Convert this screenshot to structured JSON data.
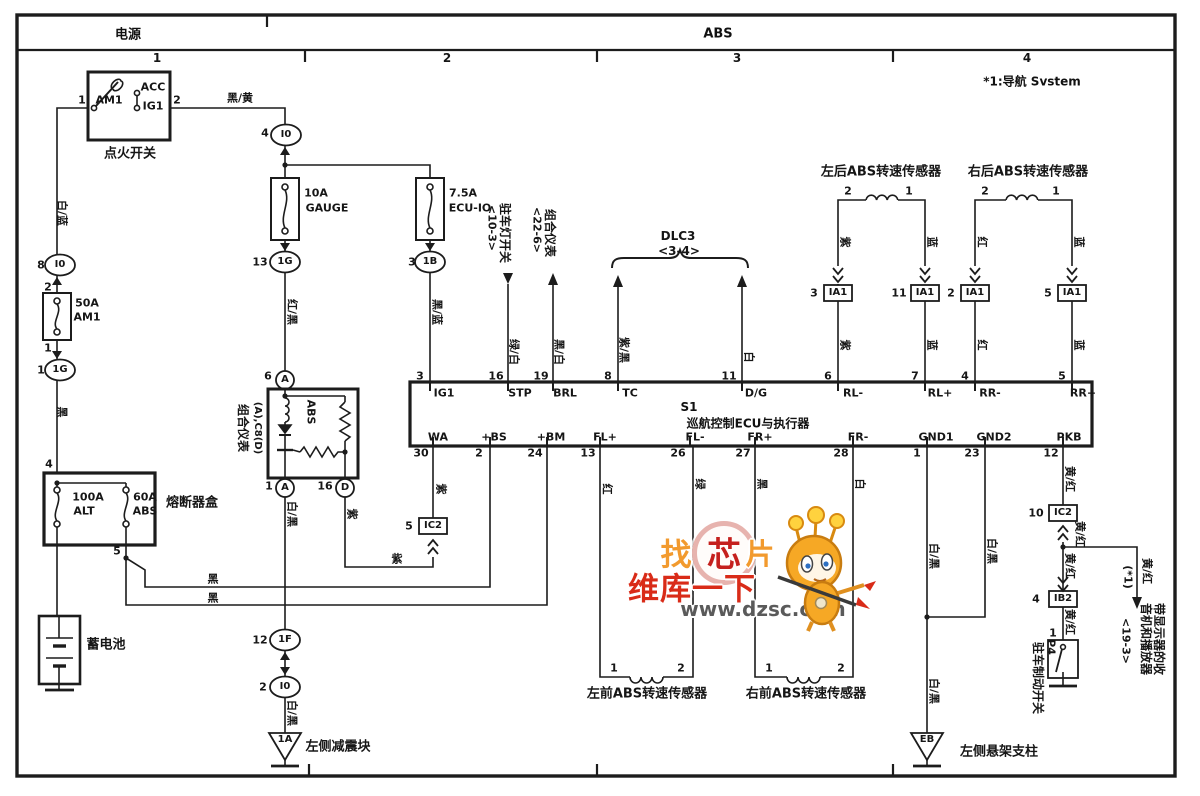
{
  "header": {
    "power_label": "电源",
    "system_label": "ABS",
    "note": "*1:导航 Svstem",
    "columns": [
      "1",
      "2",
      "3",
      "4"
    ],
    "column_xs": [
      157,
      447,
      737,
      1027
    ],
    "column_y": 58
  },
  "ecu": {
    "id": "S1",
    "name": "巡航控制ECU与执行器"
  },
  "watermark": {
    "char_left": "找",
    "char_mid": "芯",
    "char_right": "片",
    "brand": "维库一下",
    "url": "www.dzsc.com",
    "orange": "#f29a2e",
    "red": "#d92b18",
    "url_gray": "#5a5a5a"
  },
  "colors": {
    "line": "#1c1c1c",
    "paper": "#ffffff"
  },
  "labels": [
    {
      "n": "component-label",
      "t": "点火开关",
      "x": 130,
      "y": 154,
      "s": 13
    },
    {
      "n": "terminal-label",
      "t": "AM1",
      "x": 109,
      "y": 100,
      "s": 11
    },
    {
      "n": "terminal-label",
      "t": "ACC",
      "x": 153,
      "y": 87,
      "s": 11
    },
    {
      "n": "terminal-label",
      "t": "IG1",
      "x": 153,
      "y": 106,
      "s": 11
    },
    {
      "n": "pin-number",
      "t": "1",
      "x": 82,
      "y": 100,
      "s": 11
    },
    {
      "n": "pin-number",
      "t": "2",
      "x": 177,
      "y": 100,
      "s": 11
    },
    {
      "n": "wire-color-label",
      "t": "黑/黄",
      "x": 240,
      "y": 98,
      "s": 11
    },
    {
      "n": "wire-color-label",
      "t": "白/蓝",
      "x": 62,
      "y": 213,
      "r": 1,
      "s": 11
    },
    {
      "n": "pin-number",
      "t": "8",
      "x": 41,
      "y": 265,
      "s": 11
    },
    {
      "n": "connector-label",
      "t": "I0",
      "x": 60,
      "y": 265,
      "s": 10
    },
    {
      "n": "pin-number",
      "t": "2",
      "x": 48,
      "y": 287,
      "s": 11
    },
    {
      "n": "fuse-label",
      "t": "50A",
      "x": 87,
      "y": 303,
      "s": 11
    },
    {
      "n": "fuse-label",
      "t": "AM1",
      "x": 87,
      "y": 317,
      "s": 11
    },
    {
      "n": "pin-number",
      "t": "1",
      "x": 48,
      "y": 348,
      "s": 11
    },
    {
      "n": "pin-number",
      "t": "1",
      "x": 41,
      "y": 370,
      "s": 11
    },
    {
      "n": "connector-label",
      "t": "1G",
      "x": 60,
      "y": 370,
      "s": 10
    },
    {
      "n": "wire-color-label",
      "t": "黑",
      "x": 62,
      "y": 412,
      "r": 1,
      "s": 11
    },
    {
      "n": "pin-number",
      "t": "4",
      "x": 49,
      "y": 464,
      "s": 11
    },
    {
      "n": "fuse-label",
      "t": "100A",
      "x": 88,
      "y": 497,
      "s": 11
    },
    {
      "n": "fuse-label",
      "t": "ALT",
      "x": 84,
      "y": 511,
      "s": 11
    },
    {
      "n": "fuse-label",
      "t": "60A",
      "x": 145,
      "y": 497,
      "s": 11
    },
    {
      "n": "fuse-label",
      "t": "ABS",
      "x": 145,
      "y": 511,
      "s": 11
    },
    {
      "n": "component-label",
      "t": "熔断器盒",
      "x": 192,
      "y": 503,
      "s": 13
    },
    {
      "n": "pin-number",
      "t": "5",
      "x": 117,
      "y": 551,
      "s": 11
    },
    {
      "n": "component-label",
      "t": "蓄电池",
      "x": 106,
      "y": 645,
      "s": 13
    },
    {
      "n": "wire-color-label",
      "t": "黑",
      "x": 213,
      "y": 579,
      "s": 11
    },
    {
      "n": "wire-color-label",
      "t": "黑",
      "x": 213,
      "y": 598,
      "s": 11
    },
    {
      "n": "pin-number",
      "t": "4",
      "x": 265,
      "y": 133,
      "s": 11
    },
    {
      "n": "connector-label",
      "t": "I0",
      "x": 286,
      "y": 135,
      "s": 10
    },
    {
      "n": "fuse-label",
      "t": "10A",
      "x": 316,
      "y": 193,
      "s": 11
    },
    {
      "n": "fuse-label",
      "t": "GAUGE",
      "x": 327,
      "y": 208,
      "s": 11
    },
    {
      "n": "fuse-label",
      "t": "7.5A",
      "x": 463,
      "y": 193,
      "s": 11
    },
    {
      "n": "fuse-label",
      "t": "ECU-IO",
      "x": 470,
      "y": 208,
      "s": 11
    },
    {
      "n": "pin-number",
      "t": "13",
      "x": 260,
      "y": 262,
      "s": 11
    },
    {
      "n": "connector-label",
      "t": "1G",
      "x": 285,
      "y": 262,
      "s": 10
    },
    {
      "n": "wire-color-label",
      "t": "红/黑",
      "x": 292,
      "y": 312,
      "r": 1,
      "s": 11
    },
    {
      "n": "pin-number",
      "t": "3",
      "x": 412,
      "y": 262,
      "s": 11
    },
    {
      "n": "connector-label",
      "t": "1B",
      "x": 430,
      "y": 262,
      "s": 10
    },
    {
      "n": "wire-color-label",
      "t": "黑/蓝",
      "x": 437,
      "y": 312,
      "r": 1,
      "s": 11
    },
    {
      "n": "pin-number",
      "t": "6",
      "x": 268,
      "y": 376,
      "s": 11
    },
    {
      "n": "connector-label",
      "t": "A",
      "x": 285,
      "y": 380,
      "s": 10
    },
    {
      "n": "component-label",
      "t": "组合仪表",
      "x": 243,
      "y": 428,
      "r": 1,
      "s": 12
    },
    {
      "n": "component-label",
      "t": "(A),C8(D)",
      "x": 257,
      "y": 428,
      "r": 1,
      "s": 10
    },
    {
      "n": "lamp-label",
      "t": "ABS",
      "x": 311,
      "y": 412,
      "r": 1,
      "s": 11
    },
    {
      "n": "pin-number",
      "t": "1",
      "x": 269,
      "y": 486,
      "s": 11
    },
    {
      "n": "connector-label",
      "t": "A",
      "x": 285,
      "y": 488,
      "s": 10
    },
    {
      "n": "pin-number",
      "t": "16",
      "x": 325,
      "y": 486,
      "s": 11
    },
    {
      "n": "connector-label",
      "t": "D",
      "x": 345,
      "y": 488,
      "s": 10
    },
    {
      "n": "wire-color-label",
      "t": "白/黑",
      "x": 292,
      "y": 514,
      "r": 1,
      "s": 11
    },
    {
      "n": "wire-color-label",
      "t": "紫",
      "x": 352,
      "y": 514,
      "r": 1,
      "s": 11
    },
    {
      "n": "wire-color-label",
      "t": "紫",
      "x": 397,
      "y": 559,
      "s": 11
    },
    {
      "n": "pin-number",
      "t": "5",
      "x": 409,
      "y": 526,
      "s": 11
    },
    {
      "n": "connector-label",
      "t": "IC2",
      "x": 433,
      "y": 526,
      "s": 10
    },
    {
      "n": "wire-color-label",
      "t": "紫",
      "x": 441,
      "y": 489,
      "r": 1,
      "s": 11
    },
    {
      "n": "pin-number",
      "t": "12",
      "x": 260,
      "y": 640,
      "s": 11
    },
    {
      "n": "connector-label",
      "t": "1F",
      "x": 285,
      "y": 640,
      "s": 10
    },
    {
      "n": "pin-number",
      "t": "2",
      "x": 263,
      "y": 687,
      "s": 11
    },
    {
      "n": "connector-label",
      "t": "I0",
      "x": 285,
      "y": 687,
      "s": 10
    },
    {
      "n": "wire-color-label",
      "t": "白/黑",
      "x": 292,
      "y": 713,
      "r": 1,
      "s": 11
    },
    {
      "n": "ground-id",
      "t": "1A",
      "x": 285,
      "y": 740,
      "s": 10
    },
    {
      "n": "component-label",
      "t": "左侧减震块",
      "x": 338,
      "y": 747,
      "s": 13
    },
    {
      "n": "pin-number",
      "t": "3",
      "x": 420,
      "y": 376,
      "s": 11
    },
    {
      "n": "ecu-pin-label",
      "t": "IG1",
      "x": 444,
      "y": 393,
      "s": 11
    },
    {
      "n": "pin-number",
      "t": "16",
      "x": 496,
      "y": 376,
      "s": 11
    },
    {
      "n": "ecu-pin-label",
      "t": "STP",
      "x": 520,
      "y": 393,
      "s": 11
    },
    {
      "n": "pin-number",
      "t": "19",
      "x": 541,
      "y": 376,
      "s": 11
    },
    {
      "n": "ecu-pin-label",
      "t": "BRL",
      "x": 565,
      "y": 393,
      "s": 11
    },
    {
      "n": "pin-number",
      "t": "8",
      "x": 608,
      "y": 376,
      "s": 11
    },
    {
      "n": "ecu-pin-label",
      "t": "TC",
      "x": 630,
      "y": 393,
      "s": 11
    },
    {
      "n": "pin-number",
      "t": "11",
      "x": 729,
      "y": 376,
      "s": 11
    },
    {
      "n": "ecu-pin-label",
      "t": "D/G",
      "x": 756,
      "y": 393,
      "s": 11
    },
    {
      "n": "pin-number",
      "t": "6",
      "x": 828,
      "y": 376,
      "s": 11
    },
    {
      "n": "ecu-pin-label",
      "t": "RL-",
      "x": 853,
      "y": 393,
      "s": 11
    },
    {
      "n": "pin-number",
      "t": "7",
      "x": 915,
      "y": 376,
      "s": 11
    },
    {
      "n": "ecu-pin-label",
      "t": "RL+",
      "x": 940,
      "y": 393,
      "s": 11
    },
    {
      "n": "pin-number",
      "t": "4",
      "x": 965,
      "y": 376,
      "s": 11
    },
    {
      "n": "ecu-pin-label",
      "t": "RR-",
      "x": 990,
      "y": 393,
      "s": 11
    },
    {
      "n": "pin-number",
      "t": "5",
      "x": 1062,
      "y": 376,
      "s": 11
    },
    {
      "n": "ecu-pin-label",
      "t": "RR+",
      "x": 1083,
      "y": 393,
      "s": 11
    },
    {
      "n": "ecu-pin-label",
      "t": "WA",
      "x": 438,
      "y": 437,
      "s": 11
    },
    {
      "n": "pin-number",
      "t": "30",
      "x": 421,
      "y": 453,
      "s": 11
    },
    {
      "n": "ecu-pin-label",
      "t": "+BS",
      "x": 494,
      "y": 437,
      "s": 11
    },
    {
      "n": "pin-number",
      "t": "2",
      "x": 479,
      "y": 453,
      "s": 11
    },
    {
      "n": "ecu-pin-label",
      "t": "+BM",
      "x": 551,
      "y": 437,
      "s": 11
    },
    {
      "n": "pin-number",
      "t": "24",
      "x": 535,
      "y": 453,
      "s": 11
    },
    {
      "n": "ecu-pin-label",
      "t": "FL+",
      "x": 605,
      "y": 437,
      "s": 11
    },
    {
      "n": "pin-number",
      "t": "13",
      "x": 588,
      "y": 453,
      "s": 11
    },
    {
      "n": "ecu-pin-label",
      "t": "FL-",
      "x": 695,
      "y": 437,
      "s": 11
    },
    {
      "n": "pin-number",
      "t": "26",
      "x": 678,
      "y": 453,
      "s": 11
    },
    {
      "n": "ecu-pin-label",
      "t": "FR+",
      "x": 760,
      "y": 437,
      "s": 11
    },
    {
      "n": "pin-number",
      "t": "27",
      "x": 743,
      "y": 453,
      "s": 11
    },
    {
      "n": "ecu-pin-label",
      "t": "FR-",
      "x": 858,
      "y": 437,
      "s": 11
    },
    {
      "n": "pin-number",
      "t": "28",
      "x": 841,
      "y": 453,
      "s": 11
    },
    {
      "n": "ecu-pin-label",
      "t": "GND1",
      "x": 936,
      "y": 437,
      "s": 11
    },
    {
      "n": "pin-number",
      "t": "1",
      "x": 917,
      "y": 453,
      "s": 11
    },
    {
      "n": "ecu-pin-label",
      "t": "GND2",
      "x": 994,
      "y": 437,
      "s": 11
    },
    {
      "n": "pin-number",
      "t": "23",
      "x": 972,
      "y": 453,
      "s": 11
    },
    {
      "n": "ecu-pin-label",
      "t": "PKB",
      "x": 1069,
      "y": 437,
      "s": 11
    },
    {
      "n": "pin-number",
      "t": "12",
      "x": 1051,
      "y": 453,
      "s": 11
    },
    {
      "n": "dest-label",
      "t": "驻车灯开关",
      "x": 505,
      "y": 233,
      "r": 1,
      "s": 12
    },
    {
      "n": "dest-ref",
      "t": "<10-3>",
      "x": 492,
      "y": 228,
      "r": 1,
      "s": 11
    },
    {
      "n": "dest-label",
      "t": "组合仪表",
      "x": 550,
      "y": 233,
      "r": 1,
      "s": 12
    },
    {
      "n": "dest-ref",
      "t": "<22-6>",
      "x": 537,
      "y": 230,
      "r": 1,
      "s": 11
    },
    {
      "n": "wire-color-label",
      "t": "绿/白",
      "x": 514,
      "y": 352,
      "r": 1,
      "s": 11
    },
    {
      "n": "wire-color-label",
      "t": "黑/白",
      "x": 559,
      "y": 352,
      "r": 1,
      "s": 11
    },
    {
      "n": "wire-color-label",
      "t": "紫/黑",
      "x": 624,
      "y": 350,
      "r": 1,
      "s": 11
    },
    {
      "n": "wire-color-label",
      "t": "白",
      "x": 749,
      "y": 357,
      "r": 1,
      "s": 11
    },
    {
      "n": "dest-label",
      "t": "DLC3",
      "x": 678,
      "y": 236,
      "s": 12
    },
    {
      "n": "dest-ref",
      "t": "<3-4>",
      "x": 679,
      "y": 251,
      "s": 12
    },
    {
      "n": "component-label",
      "t": "左后ABS转速传感器",
      "x": 881,
      "y": 172,
      "s": 13
    },
    {
      "n": "pin-number",
      "t": "2",
      "x": 848,
      "y": 191,
      "s": 11
    },
    {
      "n": "pin-number",
      "t": "1",
      "x": 909,
      "y": 191,
      "s": 11
    },
    {
      "n": "wire-color-label",
      "t": "紫",
      "x": 845,
      "y": 242,
      "r": 1,
      "s": 11
    },
    {
      "n": "wire-color-label",
      "t": "蓝",
      "x": 932,
      "y": 242,
      "r": 1,
      "s": 11
    },
    {
      "n": "pin-number",
      "t": "3",
      "x": 814,
      "y": 293,
      "s": 11
    },
    {
      "n": "connector-label",
      "t": "IA1",
      "x": 838,
      "y": 293,
      "s": 10
    },
    {
      "n": "pin-number",
      "t": "11",
      "x": 899,
      "y": 293,
      "s": 11
    },
    {
      "n": "connector-label",
      "t": "IA1",
      "x": 925,
      "y": 293,
      "s": 10
    },
    {
      "n": "wire-color-label",
      "t": "紫",
      "x": 845,
      "y": 345,
      "r": 1,
      "s": 11
    },
    {
      "n": "wire-color-label",
      "t": "蓝",
      "x": 932,
      "y": 345,
      "r": 1,
      "s": 11
    },
    {
      "n": "component-label",
      "t": "右后ABS转速传感器",
      "x": 1028,
      "y": 172,
      "s": 13
    },
    {
      "n": "pin-number",
      "t": "2",
      "x": 985,
      "y": 191,
      "s": 11
    },
    {
      "n": "pin-number",
      "t": "1",
      "x": 1056,
      "y": 191,
      "s": 11
    },
    {
      "n": "wire-color-label",
      "t": "红",
      "x": 982,
      "y": 242,
      "r": 1,
      "s": 11
    },
    {
      "n": "wire-color-label",
      "t": "蓝",
      "x": 1079,
      "y": 242,
      "r": 1,
      "s": 11
    },
    {
      "n": "pin-number",
      "t": "2",
      "x": 951,
      "y": 293,
      "s": 11
    },
    {
      "n": "connector-label",
      "t": "IA1",
      "x": 975,
      "y": 293,
      "s": 10
    },
    {
      "n": "pin-number",
      "t": "5",
      "x": 1048,
      "y": 293,
      "s": 11
    },
    {
      "n": "connector-label",
      "t": "IA1",
      "x": 1072,
      "y": 293,
      "s": 10
    },
    {
      "n": "wire-color-label",
      "t": "红",
      "x": 982,
      "y": 345,
      "r": 1,
      "s": 11
    },
    {
      "n": "wire-color-label",
      "t": "蓝",
      "x": 1079,
      "y": 345,
      "r": 1,
      "s": 11
    },
    {
      "n": "wire-color-label",
      "t": "红",
      "x": 607,
      "y": 489,
      "r": 1,
      "s": 11
    },
    {
      "n": "wire-color-label",
      "t": "绿",
      "x": 700,
      "y": 484,
      "r": 1,
      "s": 11
    },
    {
      "n": "wire-color-label",
      "t": "黑",
      "x": 762,
      "y": 484,
      "r": 1,
      "s": 11
    },
    {
      "n": "wire-color-label",
      "t": "白",
      "x": 860,
      "y": 484,
      "r": 1,
      "s": 11
    },
    {
      "n": "pin-number",
      "t": "1",
      "x": 614,
      "y": 668,
      "s": 11
    },
    {
      "n": "pin-number",
      "t": "2",
      "x": 681,
      "y": 668,
      "s": 11
    },
    {
      "n": "component-label",
      "t": "左前ABS转速传感器",
      "x": 647,
      "y": 694,
      "s": 13
    },
    {
      "n": "pin-number",
      "t": "1",
      "x": 769,
      "y": 668,
      "s": 11
    },
    {
      "n": "pin-number",
      "t": "2",
      "x": 841,
      "y": 668,
      "s": 11
    },
    {
      "n": "component-label",
      "t": "右前ABS转速传感器",
      "x": 806,
      "y": 694,
      "s": 13
    },
    {
      "n": "wire-color-label",
      "t": "白/黑",
      "x": 934,
      "y": 556,
      "r": 1,
      "s": 11
    },
    {
      "n": "wire-color-label",
      "t": "白/黑",
      "x": 992,
      "y": 551,
      "r": 1,
      "s": 11
    },
    {
      "n": "wire-color-label",
      "t": "白/黑",
      "x": 934,
      "y": 691,
      "r": 1,
      "s": 11
    },
    {
      "n": "ground-id",
      "t": "EB",
      "x": 927,
      "y": 740,
      "s": 10
    },
    {
      "n": "component-label",
      "t": "左侧悬架支柱",
      "x": 999,
      "y": 752,
      "s": 13
    },
    {
      "n": "wire-color-label",
      "t": "黄/红",
      "x": 1070,
      "y": 479,
      "r": 1,
      "s": 11
    },
    {
      "n": "pin-number",
      "t": "10",
      "x": 1036,
      "y": 513,
      "s": 11
    },
    {
      "n": "connector-label",
      "t": "IC2",
      "x": 1063,
      "y": 513,
      "s": 10
    },
    {
      "n": "wire-color-label",
      "t": "黄/红",
      "x": 1080,
      "y": 534,
      "r": 1,
      "s": 11
    },
    {
      "n": "wire-color-label",
      "t": "黄/红",
      "x": 1070,
      "y": 566,
      "r": 1,
      "s": 11
    },
    {
      "n": "wire-color-label",
      "t": "黄/红",
      "x": 1147,
      "y": 571,
      "r": 1,
      "s": 11
    },
    {
      "n": "note-ref",
      "t": "(*1)",
      "x": 1128,
      "y": 577,
      "r": 1,
      "s": 11
    },
    {
      "n": "dest-label",
      "t": "带显示器的收",
      "x": 1159,
      "y": 639,
      "r": 1,
      "s": 12
    },
    {
      "n": "dest-label",
      "t": "音机和播放器",
      "x": 1146,
      "y": 639,
      "r": 1,
      "s": 12
    },
    {
      "n": "dest-ref",
      "t": "<19-3>",
      "x": 1126,
      "y": 641,
      "r": 1,
      "s": 11
    },
    {
      "n": "pin-number",
      "t": "4",
      "x": 1036,
      "y": 599,
      "s": 11
    },
    {
      "n": "connector-label",
      "t": "IB2",
      "x": 1063,
      "y": 599,
      "s": 10
    },
    {
      "n": "wire-color-label",
      "t": "黄/红",
      "x": 1070,
      "y": 622,
      "r": 1,
      "s": 11
    },
    {
      "n": "pin-number",
      "t": "1",
      "x": 1053,
      "y": 633,
      "s": 11
    },
    {
      "n": "component-id",
      "t": "P4",
      "x": 1051,
      "y": 647,
      "r": 1,
      "s": 11
    },
    {
      "n": "component-label",
      "t": "驻车制动开关",
      "x": 1038,
      "y": 678,
      "r": 1,
      "s": 12
    }
  ]
}
